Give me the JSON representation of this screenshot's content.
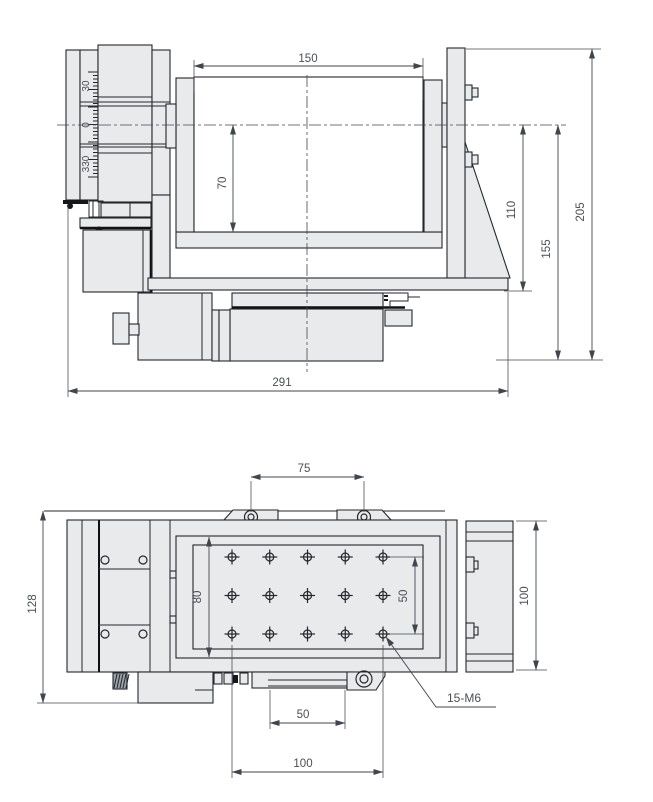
{
  "drawing": {
    "front_view": {
      "dims": {
        "top_width": "150",
        "table_height": "70",
        "center_to_base": "110",
        "center_to_bottom": "155",
        "overall_height": "205",
        "overall_width": "291"
      },
      "rotary_scale": {
        "upper": "30",
        "zero": "0",
        "lower": "330"
      }
    },
    "plan_view": {
      "dims": {
        "lug_spacing": "75",
        "overall_depth": "128",
        "table_depth": "80",
        "hole_row_span": "50",
        "body_depth": "100",
        "hole_col_span_inner": "50",
        "hole_col_span_outer": "100"
      },
      "thread_callout": "15-M6",
      "hole_grid": {
        "cols": 5,
        "rows": 3
      }
    }
  }
}
